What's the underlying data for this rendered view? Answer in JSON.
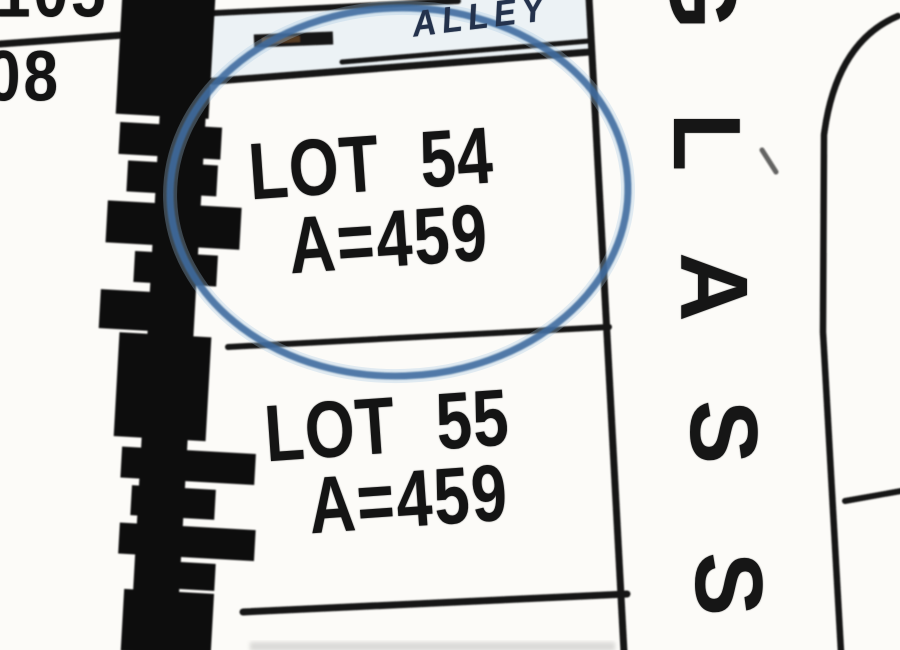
{
  "map": {
    "type": "plat-survey-map",
    "corner_numbers": {
      "top": "105",
      "bottom": "08"
    },
    "alley_label": "ALLEY",
    "street": {
      "name": "GLASS",
      "letters": [
        "G",
        "L",
        "A",
        "S",
        "S"
      ]
    },
    "lots": [
      {
        "name": "LOT 54",
        "area": "A=459",
        "annotated": "circled"
      },
      {
        "name": "LOT 55",
        "area": "A=459",
        "annotated": "none"
      }
    ],
    "colors": {
      "ink": "#141414",
      "paper": "#fcfbf8",
      "annotation_circle": "#3d6b9e",
      "annotation_glow": "#a5c6e2",
      "alley_wash": "#d9e6f1"
    }
  }
}
